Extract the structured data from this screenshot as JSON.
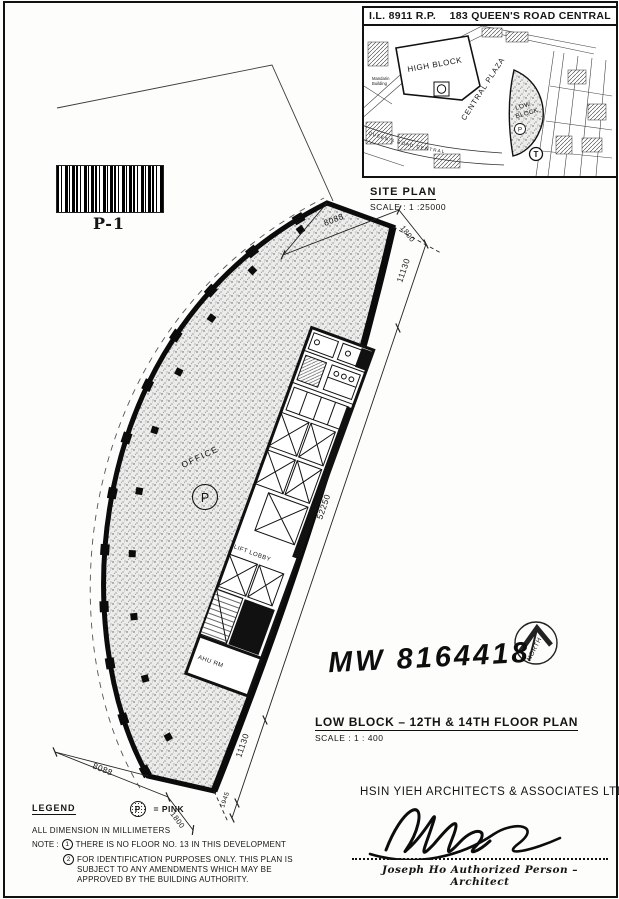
{
  "site_plan": {
    "header_left": "I.L. 8911 R.P.",
    "header_right": "183 QUEEN'S ROAD CENTRAL",
    "title": "SITE PLAN",
    "scale": "SCALE : 1 :25000",
    "labels": {
      "mandarin_line1": "Mandarin",
      "mandarin_line2": "Building",
      "high_block": "HIGH BLOCK",
      "central_plaza": "CENTRAL PLAZA",
      "low_block_line1": "LOW",
      "low_block_line2": "BLOCK",
      "p_marker": "P",
      "t_marker": "T",
      "queens_road": "QUEEN'S  ROAD  CENTRAL"
    }
  },
  "barcode": {
    "label": "P-1"
  },
  "floor_plan": {
    "office_label": "OFFICE",
    "office_symbol": "P",
    "lift_lobby_label": "LIFT LOBBY",
    "ahu_label": "AHU RM",
    "dims": {
      "top_width": "8088",
      "top_offset": "1800",
      "right_upper": "11130",
      "right_main": "52250",
      "right_lower": "11130",
      "right_end": "1945",
      "bottom_width": "8088",
      "bottom_offset": "1800"
    }
  },
  "annotations": {
    "handwritten": "MW 8164418",
    "north_label": "NORTH"
  },
  "plan_title": {
    "title": "LOW BLOCK – 12TH & 14TH FLOOR PLAN",
    "scale": "SCALE : 1 : 400"
  },
  "legend": {
    "heading": "LEGEND",
    "symbol": "P",
    "equals_text": "= PINK",
    "dimension_note": "ALL DIMENSION IN MILLIMETERS",
    "note_label": "NOTE :",
    "note1_num": "1",
    "note1": "THERE IS NO FLOOR NO. 13 IN THIS DEVELOPMENT",
    "note2_num": "2",
    "note2": "FOR IDENTIFICATION PURPOSES ONLY. THIS PLAN IS SUBJECT TO ANY AMENDMENTS WHICH MAY BE APPROVED BY THE BUILDING AUTHORITY."
  },
  "signature_block": {
    "firm": "HSIN YIEH ARCHITECTS & ASSOCIATES LTD.",
    "signer": "Joseph Ho Authorized Person – Architect"
  },
  "colors": {
    "ink": "#151515",
    "paper": "#fdfdfb"
  }
}
